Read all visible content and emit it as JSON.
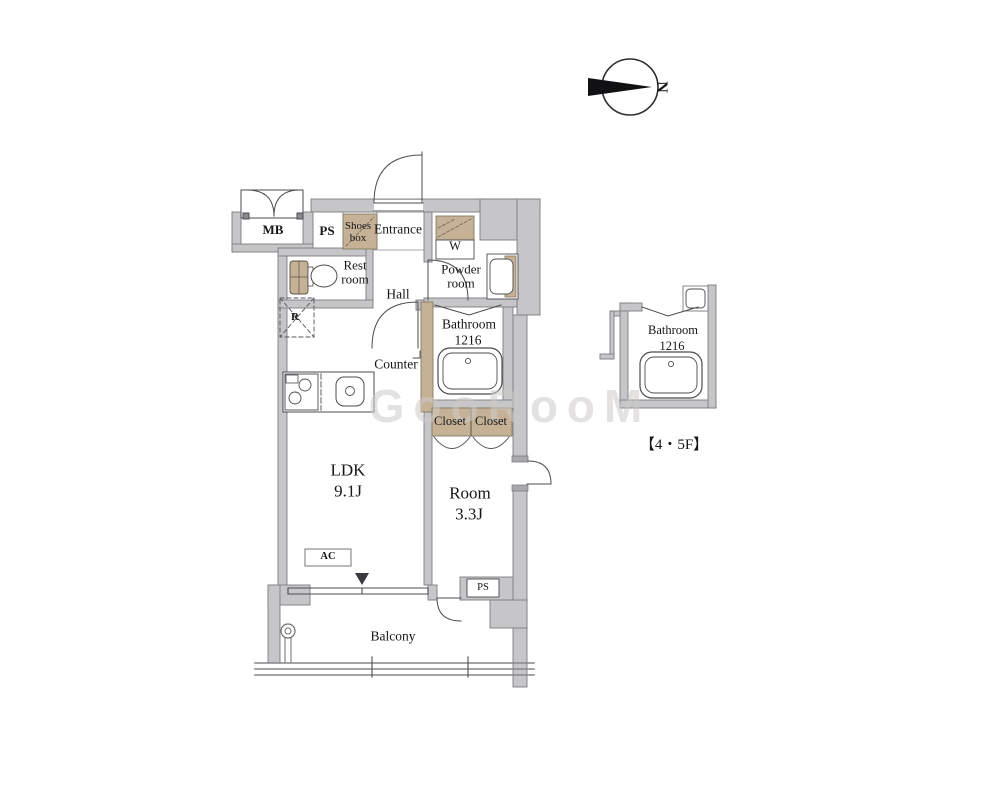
{
  "watermark": {
    "text": "GooRooM"
  },
  "compass": {
    "north": "N"
  },
  "plan": {
    "mb": "MB",
    "ps_top": "PS",
    "shoes_box": "Shoes box",
    "entrance": "Entrance",
    "washer": "W",
    "rest_room": "Rest room",
    "hall": "Hall",
    "powder_room": "Powder room",
    "bathroom": "Bathroom",
    "bathroom_size": "1216",
    "counter": "Counter",
    "fridge": "R",
    "closet_left": "Closet",
    "closet_right": "Closet",
    "ldk": "LDK",
    "ldk_size": "9.1J",
    "room": "Room",
    "room_size": "3.3J",
    "ac": "AC",
    "ps_bottom": "PS",
    "balcony": "Balcony"
  },
  "inset": {
    "bathroom": "Bathroom",
    "bathroom_size": "1216",
    "caption": "【4・5F】"
  },
  "colors": {
    "wall": "#c6c6c8",
    "wall_edge": "#7d7d81",
    "wood": "#c5b296",
    "line": "#4c4c50"
  }
}
